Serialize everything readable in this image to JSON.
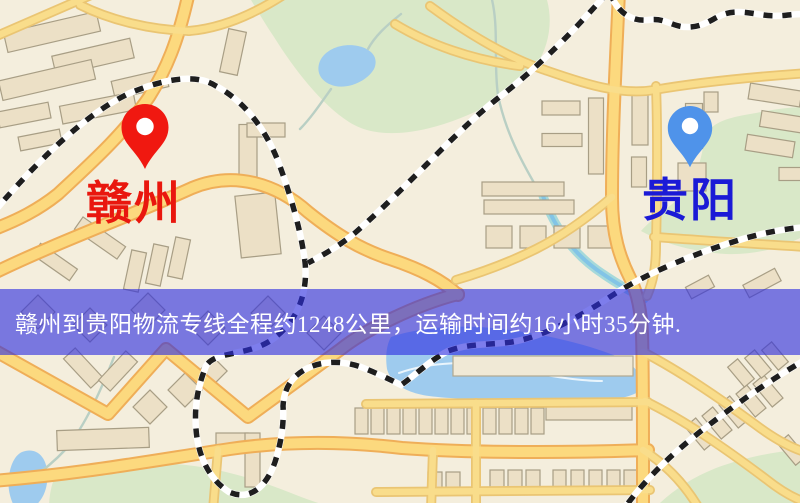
{
  "markers": {
    "origin": {
      "label": "赣州",
      "icon": "red-map-pin",
      "pin_color": "#f01810",
      "label_color": "#e9170e"
    },
    "destination": {
      "label": "贵阳",
      "icon": "blue-map-pin",
      "pin_color": "#4f93ea",
      "label_color": "#1b1ad6"
    }
  },
  "banner": {
    "text": "赣州到贵阳物流专线全程约1248公里，运输时间约16小时35分钟.",
    "origin_city": "赣州",
    "destination_city": "贵阳",
    "distance_km": "1248",
    "transit_time": "16小时35分钟"
  },
  "colors": {
    "banner_bg": "#2d2de1",
    "banner_text": "#ffffff",
    "pin_red": "#f01810",
    "pin_blue": "#4f93ea",
    "label_red": "#e9170e",
    "label_blue": "#1b1ad6",
    "map_bg": "#f4eedd",
    "road_fill": "#fcd97e",
    "road_casing": "#efae58",
    "minor_road_fill": "#f9dd8b",
    "minor_road_casing": "#eac573",
    "building_fill": "#ece0c6",
    "building_outline": "#a89e85",
    "park_green": "#d9e8c8",
    "water_blue": "#9ecbee",
    "railway_dark": "#1e1e1e",
    "stream_teal": "#a6d9da"
  }
}
